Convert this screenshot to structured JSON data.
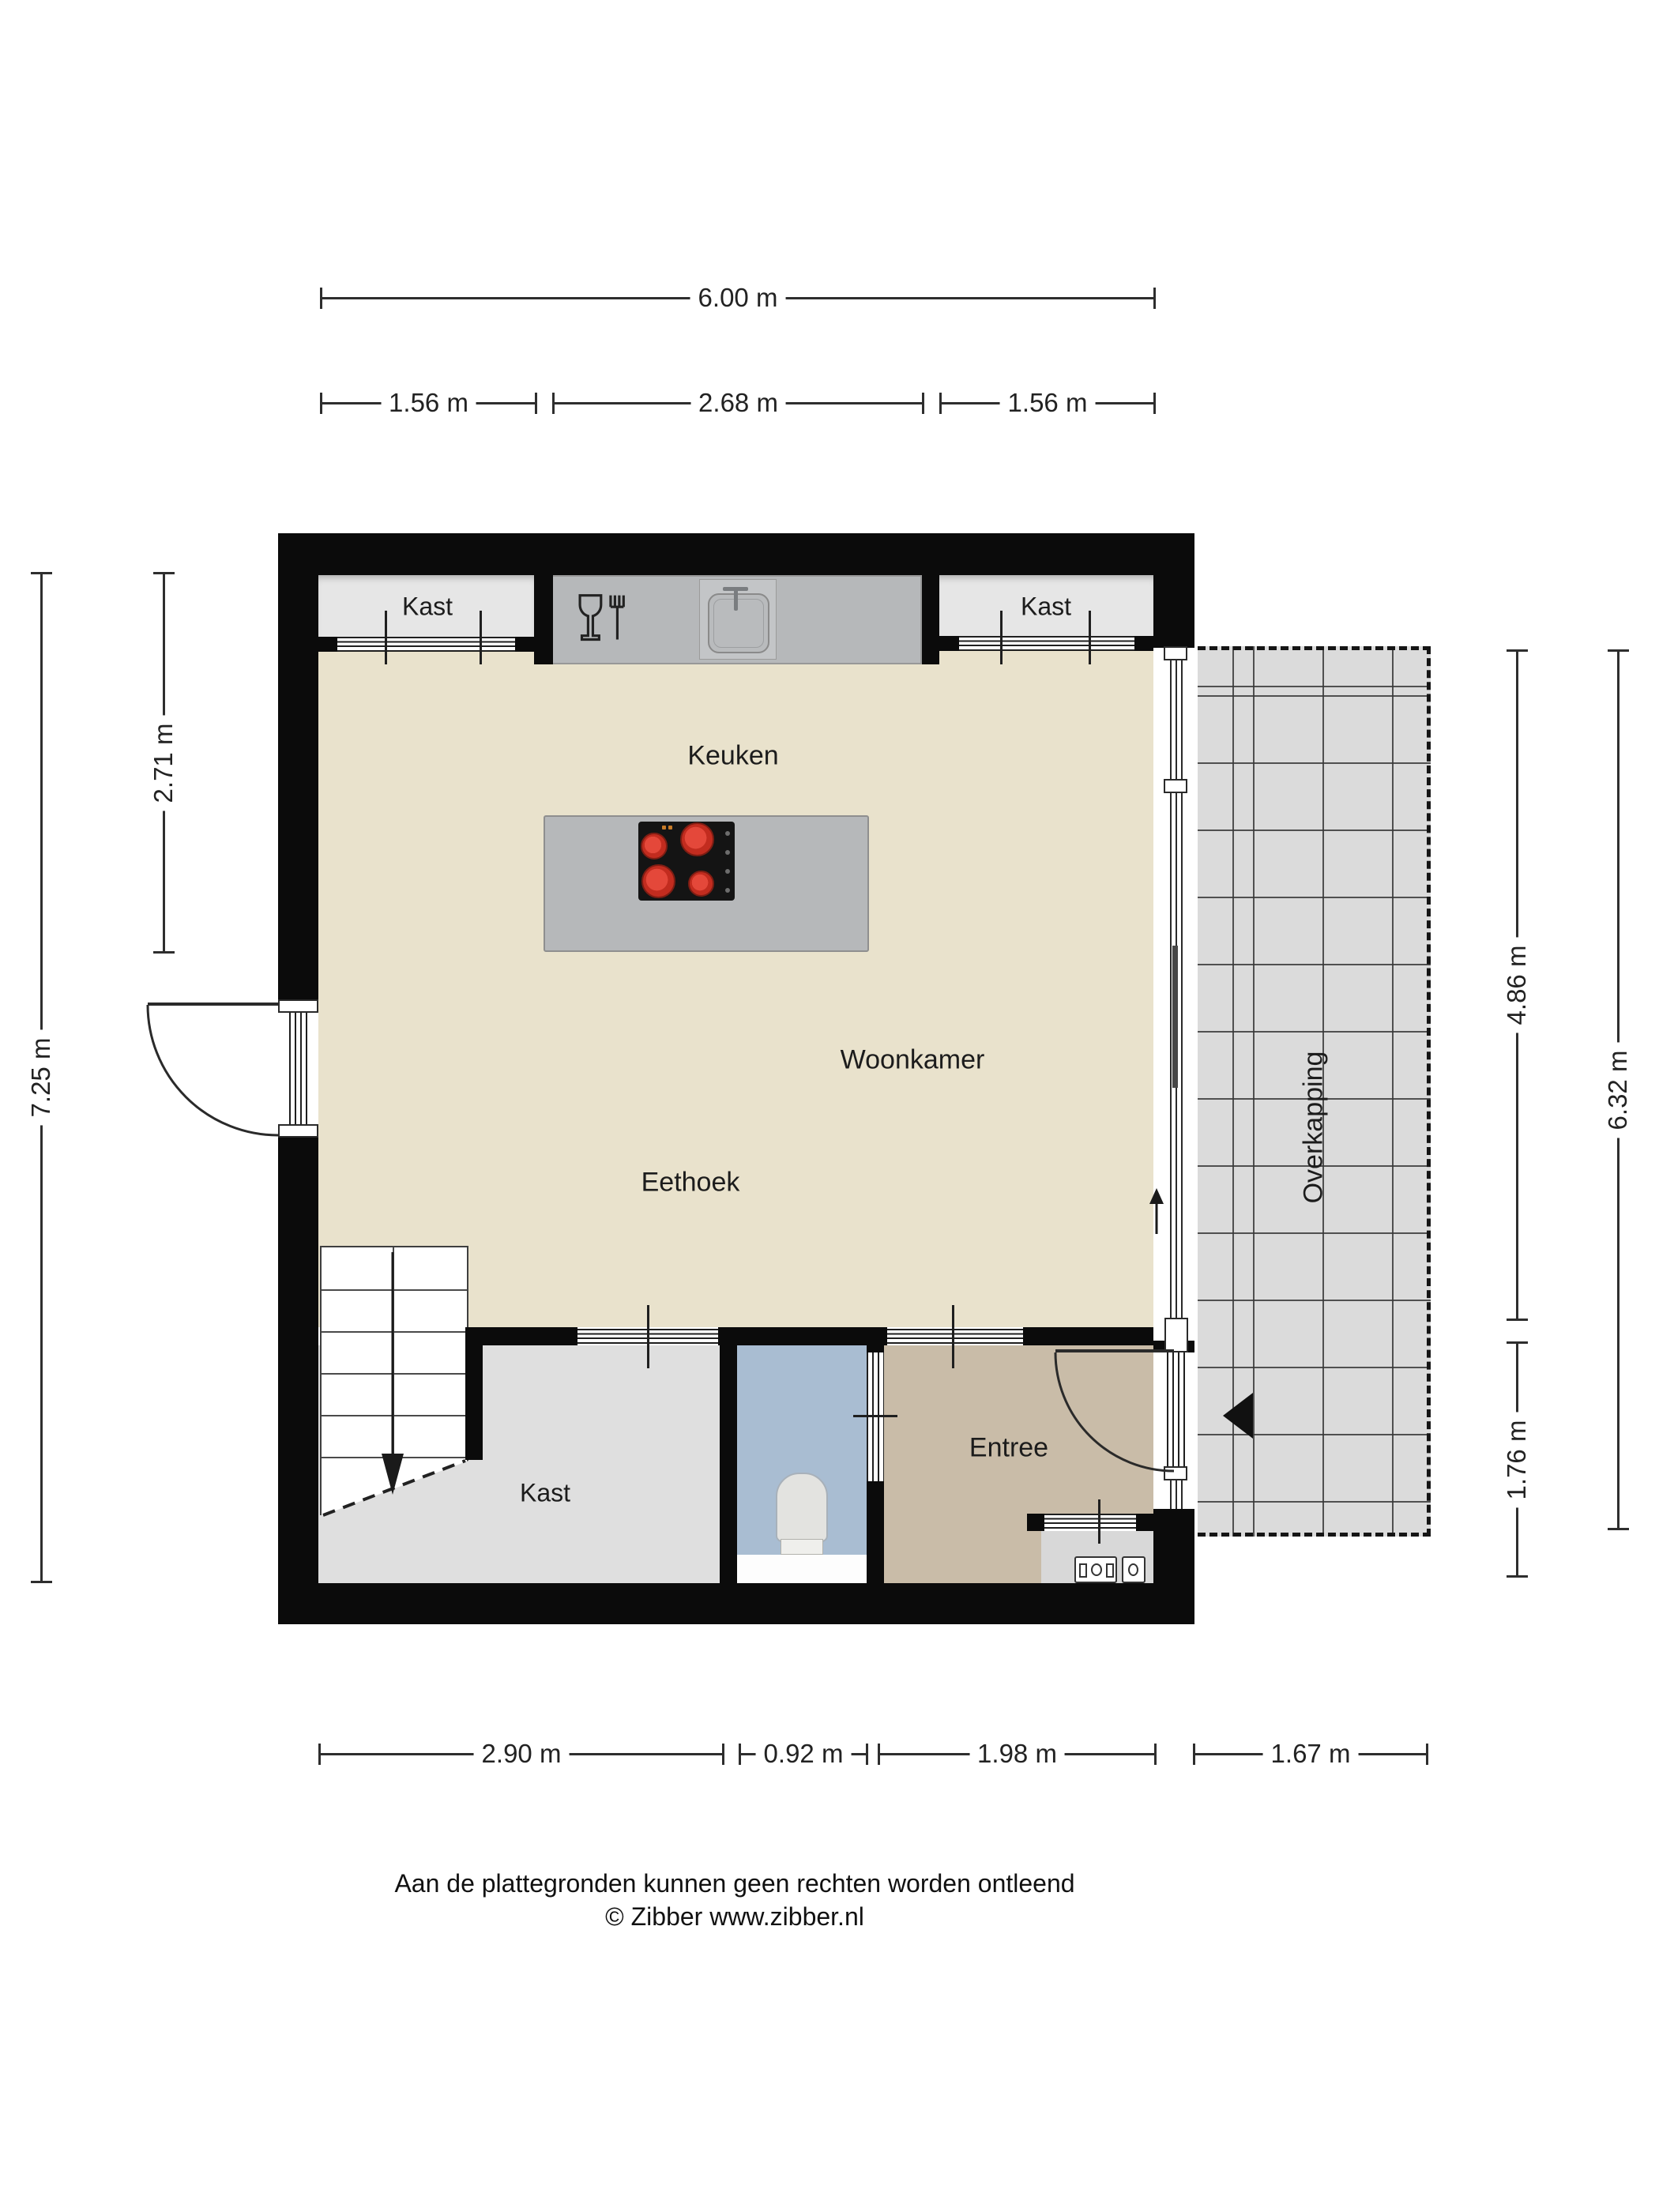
{
  "dims": {
    "top_total": "6.00 m",
    "top_segments": [
      "1.56 m",
      "2.68 m",
      "1.56 m"
    ],
    "bottom_segments": [
      "2.90 m",
      "0.92 m",
      "1.98 m",
      "1.67 m"
    ],
    "left_total": "7.25 m",
    "left_upper": "2.71 m",
    "right_upper": "4.86 m",
    "right_lower": "1.76 m",
    "right_total": "6.32 m"
  },
  "rooms": {
    "kast_top_left": "Kast",
    "kast_top_right": "Kast",
    "keuken": "Keuken",
    "woonkamer": "Woonkamer",
    "eethoek": "Eethoek",
    "kast_bottom": "Kast",
    "entree": "Entree",
    "overkapping": "Overkapping"
  },
  "footer": {
    "disclaimer": "Aan de plattegronden kunnen geen rechten worden ontleend",
    "copyright": "© Zibber www.zibber.nl"
  },
  "colors": {
    "wall": "#0b0b0b",
    "living_floor": "#e9e2cc",
    "kast_room_floor": "#dfdfdf",
    "toilet_floor": "#a9bdd2",
    "entree_floor": "#c9bca8",
    "niche_gray": "#e6e6e6",
    "counter_gray": "#b6b8ba",
    "overkapping_gray": "#dbdbdb",
    "burner_red": "#d23527",
    "cooktop_black": "#141414"
  },
  "icons": [
    "sink-icon",
    "glass-fork-icon",
    "cooktop-icon",
    "toilet-icon",
    "stairs-down-arrow-icon",
    "door-swing-arc-icon",
    "slide-direction-arrow-icon",
    "entrance-triangle-icon",
    "meter-box-icon"
  ]
}
